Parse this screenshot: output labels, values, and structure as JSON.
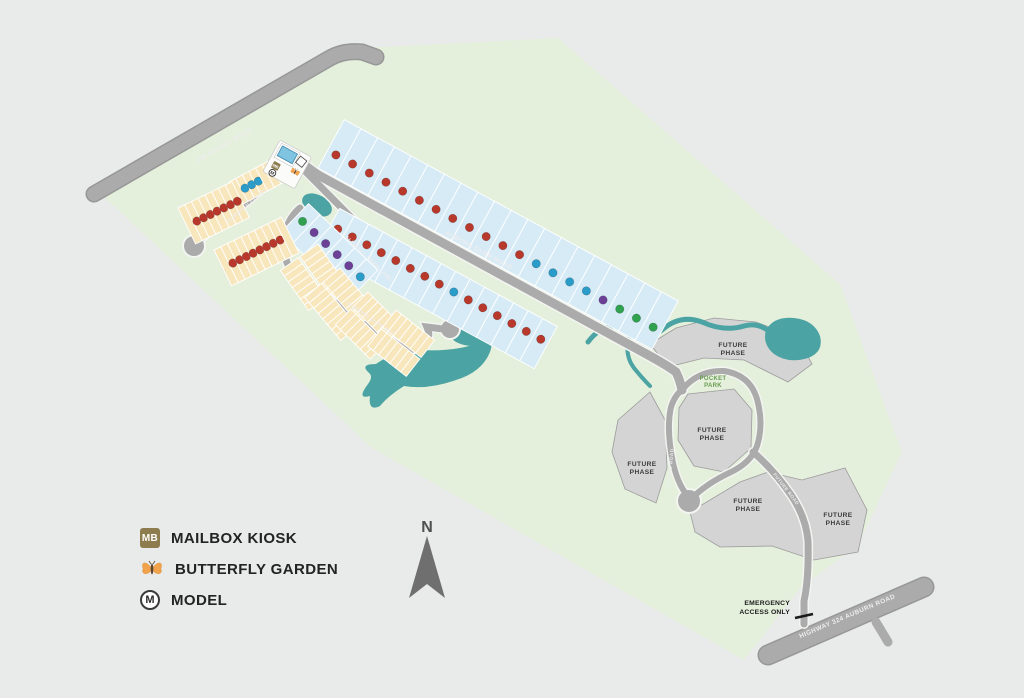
{
  "legend": {
    "items": [
      {
        "id": "mailbox-kiosk",
        "icon": "MB",
        "label": "MAILBOX KIOSK"
      },
      {
        "id": "butterfly-garden",
        "icon": "butterfly",
        "label": "BUTTERFLY GARDEN"
      },
      {
        "id": "model",
        "icon": "M",
        "label": "MODEL"
      }
    ]
  },
  "compass": {
    "label": "N"
  },
  "road_labels": {
    "jim_moore": "JIM MOORE ROAD",
    "auburn_glen": "AUBURN GLEN ROAD",
    "durston_court": "DURSTON COURT",
    "caldwell_bend": "CALDWELL BEND LANE",
    "morning_glen": "MORNING GLEN WAY",
    "future_road": "FUTURE ROAD",
    "highway": "HIGHWAY 324 AUBURN ROAD"
  },
  "area_labels": {
    "future_phase_line1": "FUTURE",
    "future_phase_line2": "PHASE",
    "pocket_park_line1": "POCKET",
    "pocket_park_line2": "PARK",
    "emergency_line1": "EMERGENCY",
    "emergency_line2": "ACCESS ONLY"
  },
  "map_data": {
    "colors": {
      "background": "#e9eaea",
      "community_green": "#e4efdc",
      "road": "#ababab",
      "road_casing": "#f3f5f1",
      "water": "#4ba4a3",
      "future_phase": "#d4d4d4",
      "future_phase_stroke": "#9c9c9c",
      "lot_blue": "#d7ebf7",
      "lot_tan": "#f8e7bd",
      "lot_stroke": "#ffffff",
      "dot_red": "#b8392c",
      "dot_teal": "#2a9cc9",
      "dot_purple": "#6d4098",
      "dot_green": "#2fa14f"
    },
    "lot_rows": [
      {
        "id": "north-auburn-glen",
        "fill": "blue",
        "x": 318,
        "y": 168,
        "angle": 28.5,
        "count": 20,
        "w": 19,
        "depth": 55,
        "offset": -55,
        "dot_y": -20,
        "double": false,
        "dots": [
          "red",
          "red",
          "red",
          "red",
          "red",
          "red",
          "red",
          "red",
          "red",
          "red",
          "red",
          "red",
          "teal",
          "teal",
          "teal",
          "teal",
          "purple",
          "green",
          "green",
          "green"
        ]
      },
      {
        "id": "south-auburn-glen",
        "fill": "blue",
        "x": 342,
        "y": 204,
        "angle": 28.5,
        "count": 15,
        "w": 16.5,
        "depth": 48,
        "offset": 5,
        "dot_y": 24,
        "double": false,
        "dots": [
          "red",
          "red",
          "red",
          "red",
          "red",
          "red",
          "red",
          "red",
          "teal",
          "red",
          "red",
          "red",
          "red",
          "red",
          "red"
        ]
      },
      {
        "id": "south-caldwell",
        "fill": "blue",
        "x": 312,
        "y": 200,
        "angle": 43.8,
        "count": 6,
        "w": 16,
        "depth": 40,
        "offset": 5,
        "dot_y": 22,
        "double": false,
        "dots": [
          "green",
          "purple",
          "purple",
          "purple",
          "purple",
          "teal"
        ]
      },
      {
        "id": "entrance-court",
        "fill": "tan",
        "x": 229,
        "y": 182,
        "angle": -28,
        "count": 7,
        "w": 7.5,
        "depth": 26,
        "offset": 0,
        "dot_y": 13,
        "double": false,
        "dots": [
          null,
          "teal",
          "teal",
          "teal",
          null,
          null,
          null
        ]
      },
      {
        "id": "durston-row-1",
        "fill": "tan",
        "x": 178,
        "y": 208,
        "angle": -26,
        "count": 8,
        "w": 7.5,
        "depth": 40,
        "offset": 0,
        "dot_y": 20,
        "double": false,
        "dots": [
          null,
          "red",
          "red",
          "red",
          "red",
          "red",
          "red",
          "red"
        ]
      },
      {
        "id": "durston-row-2",
        "fill": "tan",
        "x": 214,
        "y": 250,
        "angle": -26,
        "count": 10,
        "w": 7.5,
        "depth": 40,
        "offset": 0,
        "dot_y": 20,
        "double": false,
        "dots": [
          null,
          "red",
          "red",
          "red",
          "red",
          "red",
          "red",
          "red",
          "red",
          null
        ]
      },
      {
        "id": "townhomes-1",
        "fill": "tan",
        "x": 318,
        "y": 244,
        "angle": 55,
        "count": 7,
        "w": 7,
        "depth": 22,
        "offset": 0,
        "dot_y": 0,
        "double": true,
        "dots": null
      },
      {
        "id": "townhomes-2",
        "fill": "tan",
        "x": 340,
        "y": 268,
        "angle": 50,
        "count": 8,
        "w": 7,
        "depth": 22,
        "offset": 0,
        "dot_y": 0,
        "double": true,
        "dots": null
      },
      {
        "id": "townhomes-3",
        "fill": "tan",
        "x": 368,
        "y": 292,
        "angle": 45,
        "count": 7,
        "w": 7,
        "depth": 22,
        "offset": 0,
        "dot_y": 0,
        "double": true,
        "dots": null
      },
      {
        "id": "townhomes-4",
        "fill": "tan",
        "x": 396,
        "y": 310,
        "angle": 38,
        "count": 7,
        "w": 7,
        "depth": 22,
        "offset": 0,
        "dot_y": 0,
        "double": true,
        "dots": null
      }
    ]
  }
}
